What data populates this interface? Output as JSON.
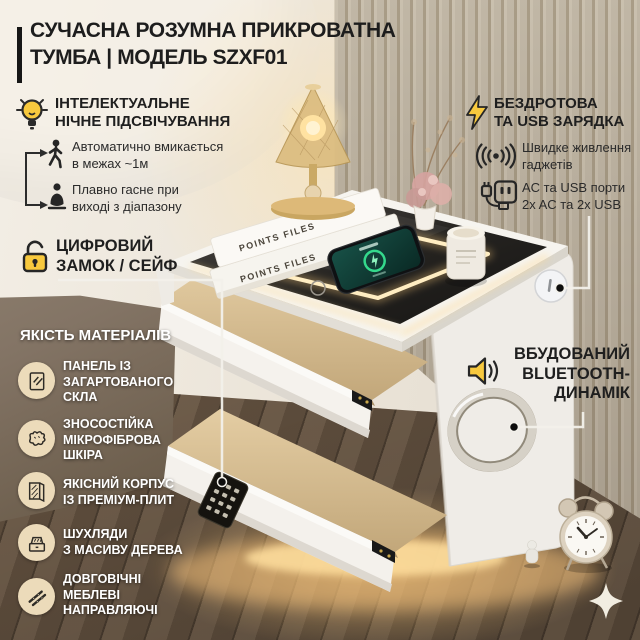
{
  "colors": {
    "accent_yellow": "#f8c93e",
    "text_dark": "#1f1f1f",
    "text_light": "#ffffff",
    "badge_bg": "#ecdbba",
    "led_glow": "#ffd98f"
  },
  "title": {
    "line1": "СУЧАСНА РОЗУМНА ПРИКРОВАТНА",
    "line2": "ТУМБА | МОДЕЛЬ SZXF01"
  },
  "night_light": {
    "icon": "lightbulb-icon",
    "heading": "ІНТЕЛЕКТУАЛЬНЕ\nНІЧНЕ ПІДСВІЧУВАННЯ",
    "items": [
      {
        "icon": "walking-person-icon",
        "text": "Автоматично вмикається\nв межах ~1м"
      },
      {
        "icon": "sitting-person-icon",
        "text": "Плавно гасне при\nвиході з діапазону"
      }
    ]
  },
  "digital_lock": {
    "icon": "padlock-icon",
    "heading": "ЦИФРОВИЙ\nЗАМОК / СЕЙФ"
  },
  "materials": {
    "heading": "ЯКІСТЬ МАТЕРІАЛІВ",
    "items": [
      {
        "icon": "glass-panel-icon",
        "text": "ПАНЕЛЬ ІЗ\nЗАГАРТОВАНОГО\nСКЛА"
      },
      {
        "icon": "leather-icon",
        "text": "ЗНОСОСТІЙКА\nМІКРОФІБРОВА\nШКІРА"
      },
      {
        "icon": "board-icon",
        "text": "ЯКІСНИЙ КОРПУС\nІЗ ПРЕМІУМ-ПЛИТ"
      },
      {
        "icon": "drawer-box-icon",
        "text": "ШУХЛЯДИ\nЗ МАСИВУ ДЕРЕВА"
      },
      {
        "icon": "rails-icon",
        "text": "ДОВГОВІЧНІ\nМЕБЛЕВІ\nНАПРАВЛЯЮЧІ"
      }
    ]
  },
  "charging": {
    "icon": "lightning-icon",
    "heading": "БЕЗДРОТОВА\nТА USB ЗАРЯДКА",
    "items": [
      {
        "icon": "wireless-signal-icon",
        "text": "Швидке живлення\nгаджетів"
      },
      {
        "icon": "power-outlet-icon",
        "text": "AC та USB порти\n2x AC та 2x USB"
      }
    ]
  },
  "speaker": {
    "icon": "speaker-icon",
    "heading": "ВБУДОВАНИЙ\nBLUETOOTH-\nДИНАМІК"
  },
  "scene": {
    "book_spine": "POINTS FILES",
    "phone_status_icon": "charging-ring-icon",
    "nightstand_parts": [
      "glass-top-led",
      "open-drawer-upper",
      "open-drawer-lower",
      "keypad-lock",
      "speaker-ring",
      "power-port",
      "under-light"
    ]
  }
}
